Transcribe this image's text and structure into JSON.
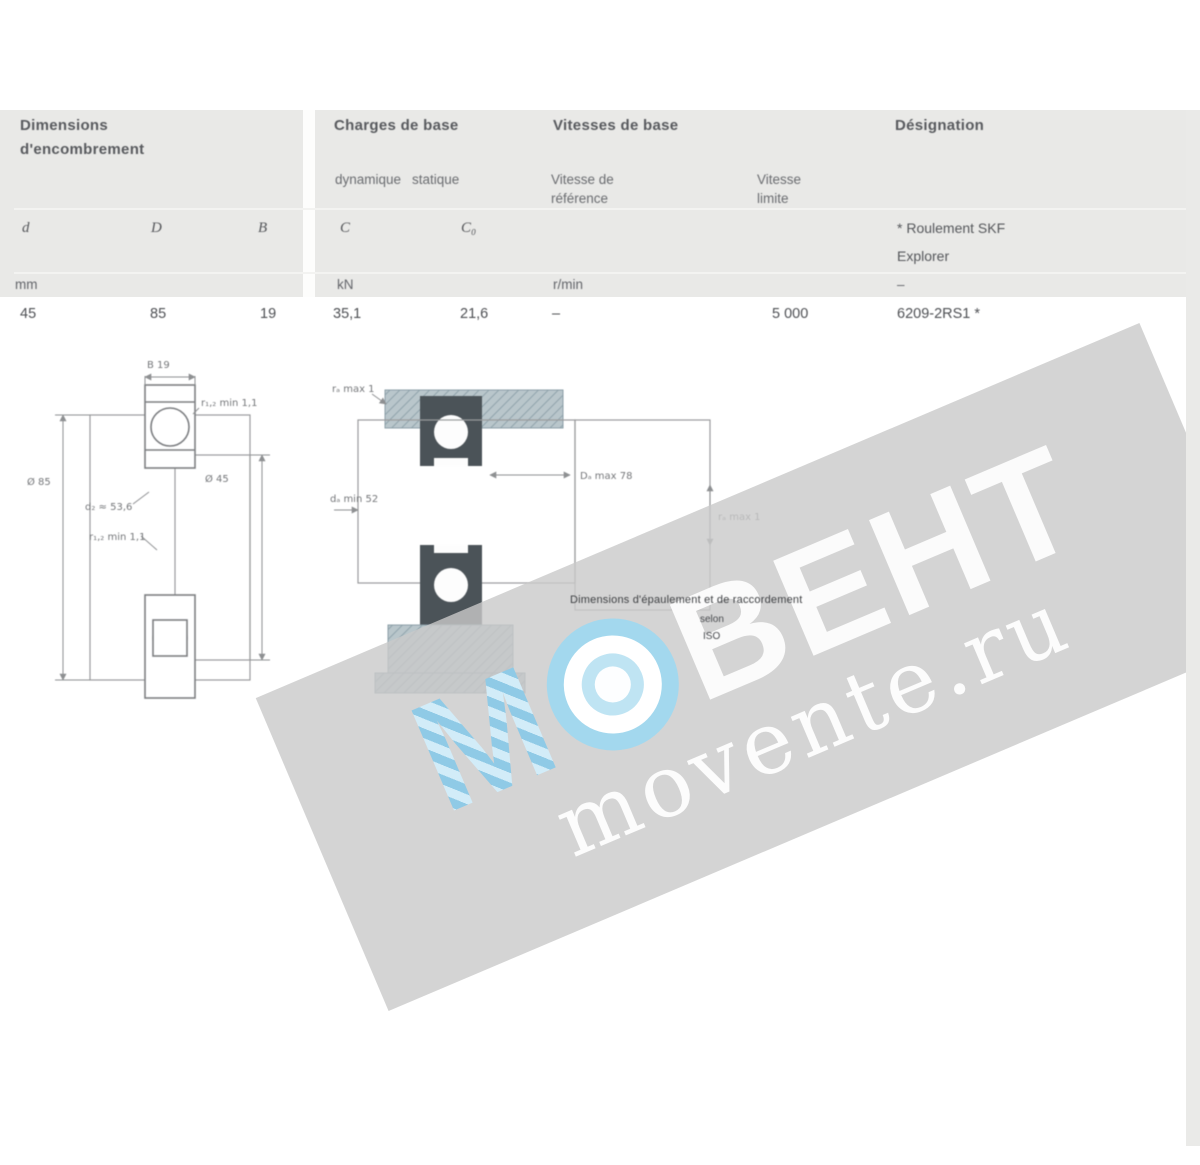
{
  "header": {
    "dim_group_l1": "Dimensions",
    "dim_group_l2": "d'encombrement",
    "loads_group": "Charges de base",
    "speeds_group": "Vitesses de base",
    "designation_group": "Désignation",
    "sub_dynamic": "dynamique",
    "sub_static": "statique",
    "sub_ref_l1": "Vitesse de",
    "sub_ref_l2": "référence",
    "sub_lim_l1": "Vitesse",
    "sub_lim_l2": "limite",
    "sym_d": "d",
    "sym_D": "D",
    "sym_B": "B",
    "sym_C": "C",
    "sym_C0": "C₀",
    "note_l1": "* Roulement SKF",
    "note_l2": "Explorer",
    "unit_mm": "mm",
    "unit_kn": "kN",
    "unit_rpm": "r/min",
    "unit_dash": "–"
  },
  "row": {
    "d": "45",
    "D": "85",
    "B": "19",
    "C": "35,1",
    "C0": "21,6",
    "v_ref": "–",
    "v_lim": "5 000",
    "designation": "6209-2RS1 *"
  },
  "drawing_bearing": {
    "b": "B 19",
    "r_top": "r₁,₂ min 1,1",
    "od": "Ø 85",
    "bore": "Ø 45",
    "d2": "d₂ ≈ 53,6",
    "r_low": "r₁,₂ min 1,1"
  },
  "drawing_mounting": {
    "ra_top": "rₐ max 1",
    "da": "dₐ min 52",
    "Da": "Dₐ max 78",
    "ra_side": "rₐ max 1"
  },
  "caption": {
    "l1": "Dimensions d'épaulement et de raccordement",
    "l2": "selon",
    "l3": "ISO"
  },
  "watermark": {
    "m": "М",
    "rest": "ВЕНТ",
    "domain": "movente.ru"
  },
  "colors": {
    "band": "#e9e9e7",
    "accent_blue": "#a3d8ee",
    "watermark_gray": "#c9c9c9"
  }
}
